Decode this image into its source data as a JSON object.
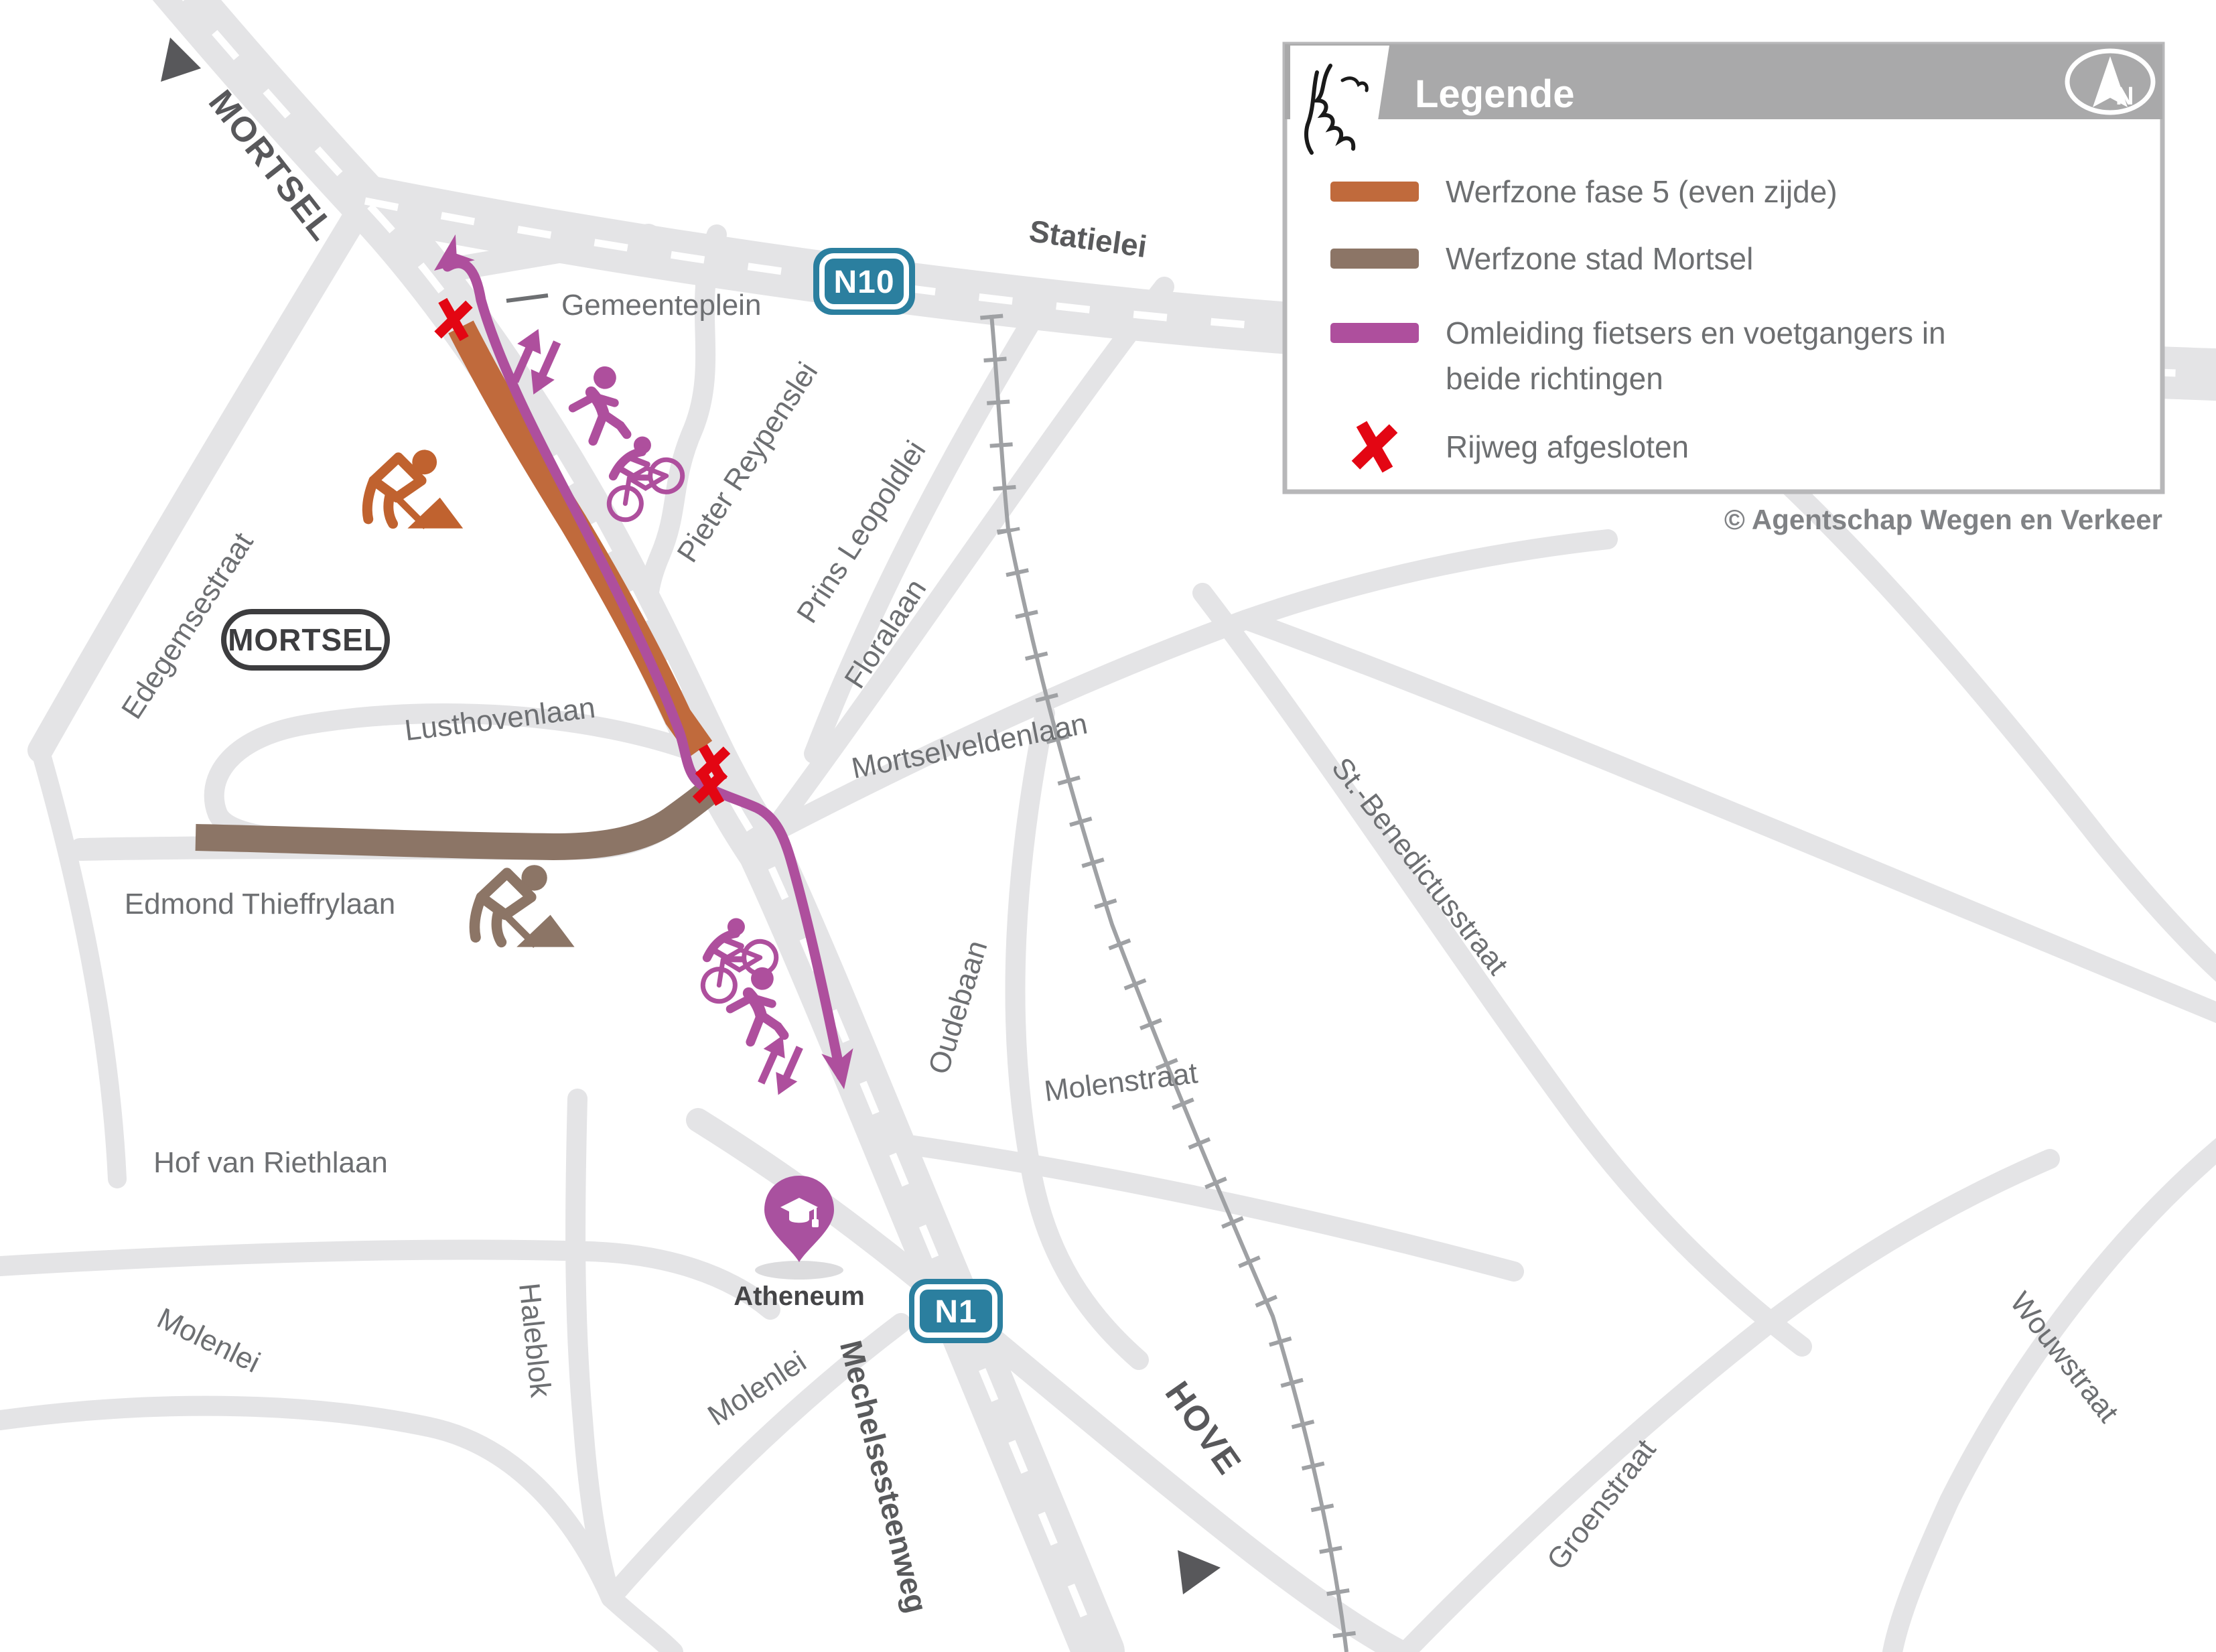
{
  "legend": {
    "title": "Legende",
    "compass_label": "N",
    "items": [
      {
        "id": "werfzone-fase5",
        "label": "Werfzone fase 5 (even zijde)",
        "color": "#c06a3c"
      },
      {
        "id": "werfzone-stad",
        "label": "Werfzone stad Mortsel",
        "color": "#8c7566"
      },
      {
        "id": "omleiding",
        "label": "Omleiding fietsers en voetgangers in beide richtingen",
        "label_lines": [
          "Omleiding fietsers en voetgangers in",
          "beide richtingen"
        ],
        "color": "#ae4f9d"
      },
      {
        "id": "rijweg-afgesloten",
        "label": "Rijweg afgesloten",
        "color": "#e30613"
      }
    ]
  },
  "credit": "© Agentschap Wegen en Verkeer",
  "badges": {
    "n10": "N10",
    "n1": "N1"
  },
  "labels": {
    "mortsel_direction": "MORTSEL",
    "hove_direction": "HOVE",
    "mortsel_city": "MORTSEL",
    "atheneum": "Atheneum",
    "statielei": "Statielei",
    "gemeenteplein": "Gemeenteplein",
    "pieter_reypenslei": "Pieter Reypenslei",
    "prins_leopoldlei": "Prins Leopoldlei",
    "floralaan": "Floralaan",
    "edegemsestraat": "Edegemsestraat",
    "lusthovenlaan": "Lusthovenlaan",
    "edmond_thieffrylaan": "Edmond Thieffrylaan",
    "mortselveldenlaan": "Mortselveldenlaan",
    "st_benedictusstraat": "St.-Benedictusstraat",
    "oudebaan": "Oudebaan",
    "molenstraat": "Molenstraat",
    "hof_van_riethlaan": "Hof van Riethlaan",
    "molenlei_west": "Molenlei",
    "molenlei_south": "Molenlei",
    "haleblok": "Haleblok",
    "mechelsesteenweg": "Mechelsesteenweg",
    "wouwstraat": "Wouwstraat",
    "groenstraat": "Groenstraat"
  },
  "icons": {
    "compass": "north-compass",
    "logo": "flanders-lion",
    "school_pin": "graduation-cap-pin",
    "worker": "roadworks-digger",
    "cyclist": "cyclist",
    "pedestrian": "pedestrian",
    "two_way_arrows": "two-way-arrows",
    "closed": "red-x"
  },
  "colors": {
    "road": "#e4e4e6",
    "road_dash": "#ffffff",
    "railway": "#9fa1a4",
    "werfzone_fase5": "#c06a3c",
    "werfzone_stad": "#8c7566",
    "detour": "#ae4f9d",
    "closed_x": "#e30613",
    "badge_teal": "#2b7f9f",
    "legend_header": "#a9a9aa",
    "street_label": "#6d6f72",
    "dark_label": "#58585b"
  }
}
